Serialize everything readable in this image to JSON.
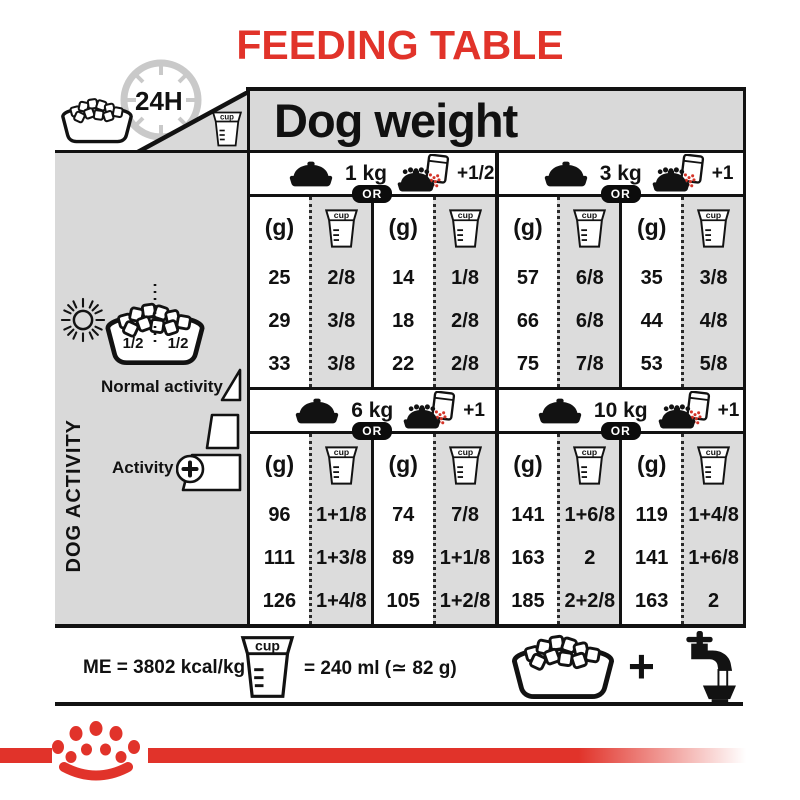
{
  "title": "FEEDING TABLE",
  "colors": {
    "red": "#e1332a",
    "panel_gray": "#d9d9d9",
    "cell_gray": "#dcdcdc",
    "black": "#121212"
  },
  "header": {
    "label": "Dog weight",
    "hours": "24H"
  },
  "sidebar": {
    "half_left": "1/2",
    "half_right": "1/2",
    "axis": "DOG ACTIVITY",
    "normal": "Normal activity",
    "active": "Activity",
    "active_plus": "+"
  },
  "table": {
    "g_label": "(g)",
    "cup_label": "cup",
    "or": "OR",
    "blocks": [
      {
        "groups": [
          {
            "weight": "1 kg",
            "extra": "+1/2",
            "bowl": {
              "rows": [
                {
                  "g": "25",
                  "cup": "2/8"
                },
                {
                  "g": "29",
                  "cup": "3/8"
                },
                {
                  "g": "33",
                  "cup": "3/8"
                }
              ]
            },
            "pouch": {
              "rows": [
                {
                  "g": "14",
                  "cup": "1/8"
                },
                {
                  "g": "18",
                  "cup": "2/8"
                },
                {
                  "g": "22",
                  "cup": "2/8"
                }
              ]
            }
          },
          {
            "weight": "3 kg",
            "extra": "+1",
            "bowl": {
              "rows": [
                {
                  "g": "57",
                  "cup": "6/8"
                },
                {
                  "g": "66",
                  "cup": "6/8"
                },
                {
                  "g": "75",
                  "cup": "7/8"
                }
              ]
            },
            "pouch": {
              "rows": [
                {
                  "g": "35",
                  "cup": "3/8"
                },
                {
                  "g": "44",
                  "cup": "4/8"
                },
                {
                  "g": "53",
                  "cup": "5/8"
                }
              ]
            }
          }
        ]
      },
      {
        "groups": [
          {
            "weight": "6 kg",
            "extra": "+1",
            "bowl": {
              "rows": [
                {
                  "g": "96",
                  "cup": "1+1/8"
                },
                {
                  "g": "111",
                  "cup": "1+3/8"
                },
                {
                  "g": "126",
                  "cup": "1+4/8"
                }
              ]
            },
            "pouch": {
              "rows": [
                {
                  "g": "74",
                  "cup": "7/8"
                },
                {
                  "g": "89",
                  "cup": "1+1/8"
                },
                {
                  "g": "105",
                  "cup": "1+2/8"
                }
              ]
            }
          },
          {
            "weight": "10 kg",
            "extra": "+1",
            "bowl": {
              "rows": [
                {
                  "g": "141",
                  "cup": "1+6/8"
                },
                {
                  "g": "163",
                  "cup": "2"
                },
                {
                  "g": "185",
                  "cup": "2+2/8"
                }
              ]
            },
            "pouch": {
              "rows": [
                {
                  "g": "119",
                  "cup": "1+4/8"
                },
                {
                  "g": "141",
                  "cup": "1+6/8"
                },
                {
                  "g": "163",
                  "cup": "2"
                }
              ]
            }
          }
        ]
      }
    ]
  },
  "footer": {
    "me": "ME = 3802 kcal/kg",
    "cup_equals": "= 240 ml (≃ 82 g)",
    "plus": "+"
  }
}
